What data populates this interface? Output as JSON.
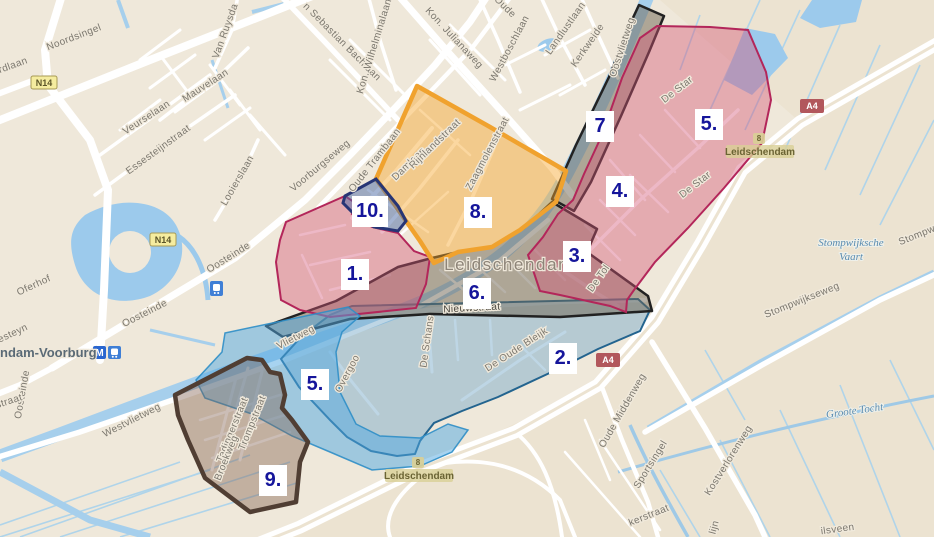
{
  "places": {
    "city": "Leidschendam",
    "station": "ndam-Voorburg",
    "water_region_1": "Stompwijksche",
    "water_region_2": "Vaart",
    "water_region_3": "Groote Tocht"
  },
  "zones": {
    "list": [
      {
        "name": "zone-1",
        "label": "1."
      },
      {
        "name": "zone-2",
        "label": "2."
      },
      {
        "name": "zone-3",
        "label": "3."
      },
      {
        "name": "zone-4",
        "label": "4."
      },
      {
        "name": "zone-5-north",
        "label": "5."
      },
      {
        "name": "zone-5-south",
        "label": "5."
      },
      {
        "name": "zone-6",
        "label": "6."
      },
      {
        "name": "zone-7",
        "label": "7"
      },
      {
        "name": "zone-8",
        "label": "8."
      },
      {
        "name": "zone-9",
        "label": "9."
      },
      {
        "name": "zone-10",
        "label": "10."
      }
    ]
  },
  "streets": [
    "Noordsingel",
    "rdlaan",
    "Van Ruysda",
    "Mauvelaan",
    "Veurselaan",
    "Essesteijnstraat",
    "Looierslaan",
    "n Sebastian Bachlaan",
    "Kon. Wilhelminalaan",
    "Kon. Julianaweg",
    "Oude",
    "Westboschlaan",
    "Landlustlaan",
    "Kerkweide",
    "Voorburgseweg",
    "Oude Trambaan",
    "Damlaan",
    "Rijnlandstraat",
    "Zaagmolenstraat",
    "Oosteinde",
    "Oferhof",
    "esteyn",
    "straat",
    "Oostvlietweg",
    "Vlietweg",
    "Westvlietweg",
    "Nieuwstraat",
    "De Schans",
    "De Oude Bleijk",
    "Overgoo",
    "De Star",
    "De Tol",
    "Trompstraat",
    "Tedingerstraat",
    "Broekweg",
    "Stompwijkseweg",
    "Stompw",
    "Kostverlorenweg",
    "Oude Middenweg",
    "Sportsingel",
    "kerstraat",
    "lijn",
    "ilsveen"
  ],
  "shields": {
    "n14": "N14",
    "a4": "A4"
  },
  "exit": {
    "number": "8",
    "name": "Leidschendam"
  },
  "icons": {
    "metro_badge": "M",
    "train_badge": "train-pictogram"
  },
  "colors": {
    "land": "#efe8da",
    "water": "#a6cfec",
    "road": "#ffffff",
    "zone_pink": "#d75678",
    "zone_orange": "#f6a72d",
    "zone_blue": "#6ea9c8",
    "zone_lightblue": "#46a6dd",
    "zone_gray": "#6e6450",
    "zone_brown": "#7d5c48",
    "zone_navy": "#3c5a9a",
    "zone_label_text": "#15159b",
    "a4_shield": "#b2575c",
    "n14_shield": "#f5ec9f"
  }
}
